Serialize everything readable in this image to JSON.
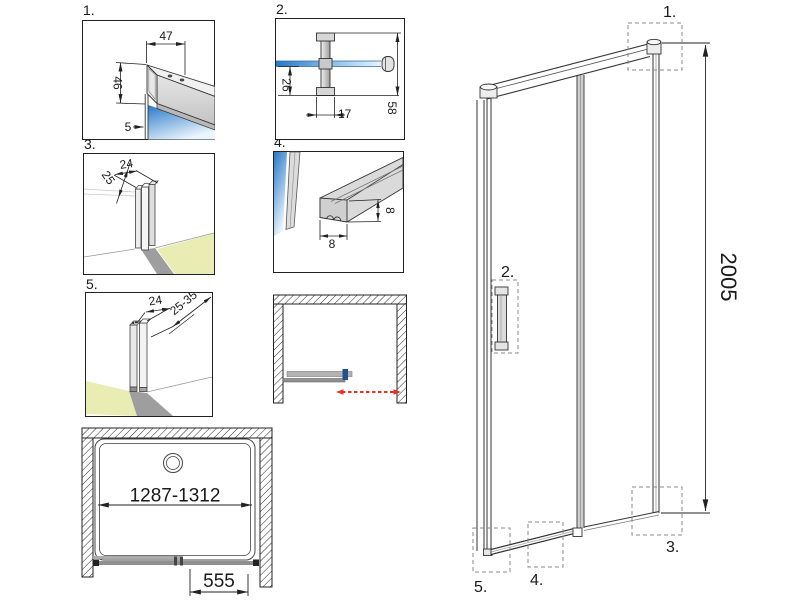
{
  "colors": {
    "line": "#222222",
    "glass_deep": "#2878c8",
    "glass_mid": "#8fc0e8",
    "glass_light": "#eaf5fd",
    "floor_yellow": "#e9edb4",
    "arrow_red": "#e63329",
    "handle_navy": "#23508f",
    "profile_gray": "#d6d6d6",
    "callout_gray": "#8a8a8a"
  },
  "details": {
    "d1": {
      "label": "1.",
      "dim_width": "47",
      "dim_height": "46",
      "dim_glass": "5"
    },
    "d2": {
      "label": "2.",
      "dim_offset": "26",
      "dim_width": "17",
      "dim_total": "58"
    },
    "d3": {
      "label": "3.",
      "dim_depth": "25",
      "dim_width": "24"
    },
    "d4": {
      "label": "4.",
      "dim_width": "8",
      "dim_height": "8"
    },
    "d5": {
      "label": "5.",
      "dim_width": "24",
      "dim_range": "25-35"
    }
  },
  "tray": {
    "width_range": "1287-1312",
    "entry_width": "555"
  },
  "elevation": {
    "height": "2005",
    "callout_1": "1.",
    "callout_2": "2.",
    "callout_3": "3.",
    "callout_4": "4.",
    "callout_5": "5."
  }
}
